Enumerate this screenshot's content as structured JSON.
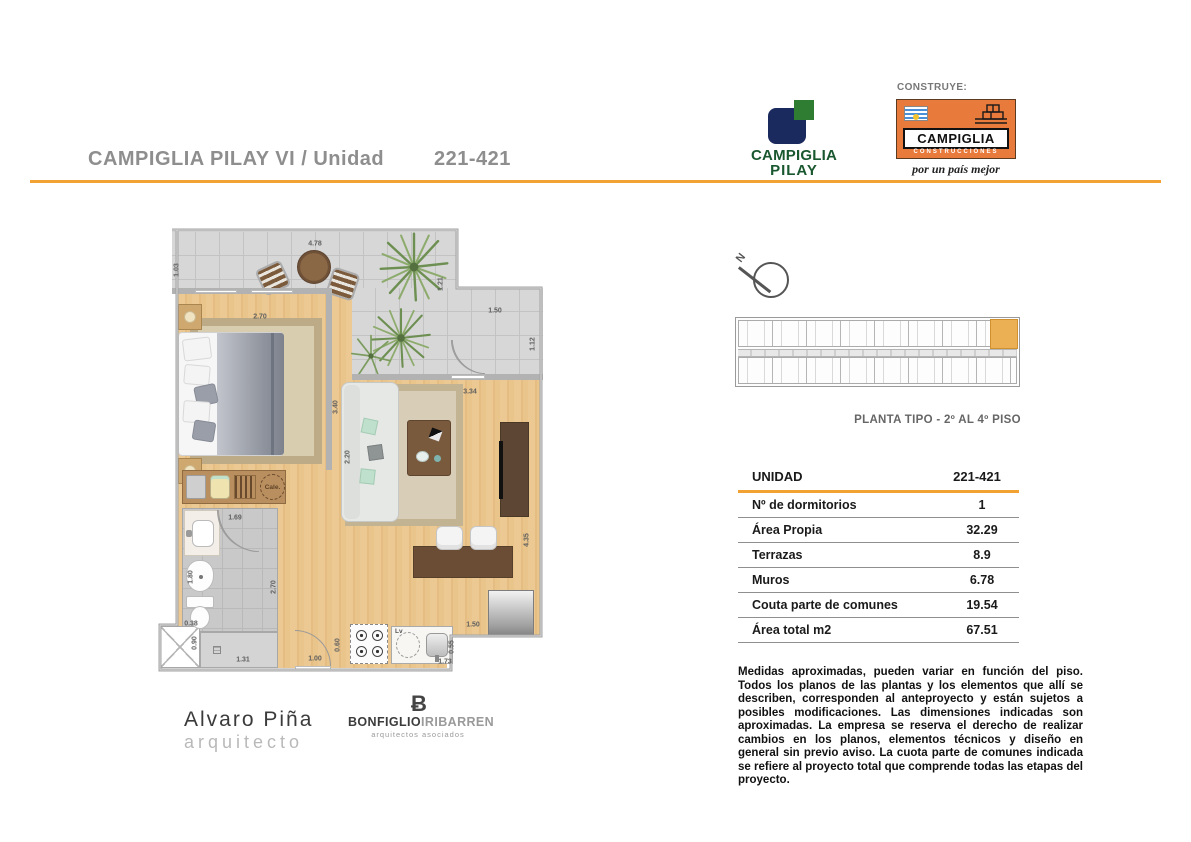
{
  "page": {
    "title_prefix": "CAMPIGLIA PILAY VI  /  Unidad",
    "unit_number": "221-421"
  },
  "logos": {
    "pilay": {
      "line1": "CAMPIGLIA",
      "line2": "PILAY"
    },
    "construye_label": "CONSTRUYE:",
    "constructor": {
      "name": "CAMPIGLIA",
      "sub": "CONSTRUCCIONES",
      "tagline": "por un país mejor"
    }
  },
  "keyplan": {
    "north_label": "N",
    "caption": "PLANTA TIPO - 2º AL 4º PISO"
  },
  "spec_table": {
    "header_label": "UNIDAD",
    "header_value": "221-421",
    "rows": [
      {
        "label": "Nº de dormitorios",
        "value": "1"
      },
      {
        "label": "Área Propia",
        "value": "32.29"
      },
      {
        "label": "Terrazas",
        "value": "8.9"
      },
      {
        "label": "Muros",
        "value": "6.78"
      },
      {
        "label": "Couta parte de comunes",
        "value": "19.54"
      },
      {
        "label": "Área total m2",
        "value": "67.51"
      }
    ]
  },
  "disclaimer": "Medidas aproximadas, pueden variar en función del piso. Todos los planos de las plantas y los elementos que allí se describen, corresponden al anteproyecto y están sujetos a posibles modificaciones. Las dimensiones indicadas son aproximadas. La empresa se reserva el derecho de realizar cambios en los planos, elementos técnicos y diseño en general sin previo aviso. La cuota parte de comunes indicada se refiere al proyecto total que comprende todas las etapas del proyecto.",
  "signatures": {
    "architect": {
      "name": "Alvaro Piña",
      "title": "arquitecto"
    },
    "studio": {
      "mark": "Ƀ",
      "name1": "BONFIGLIO",
      "name2": "IRIBARREN",
      "sub": "arquitectos asociados"
    }
  },
  "floorplan": {
    "annotations": {
      "heater": "Cale.",
      "dishwasher": "Lv"
    },
    "dim_labels": [
      {
        "t": "4.78",
        "x": 160,
        "y": 20,
        "v": 0
      },
      {
        "t": "1.03",
        "x": 22,
        "y": 46,
        "v": 1
      },
      {
        "t": "2.70",
        "x": 105,
        "y": 93,
        "v": 0
      },
      {
        "t": "1.21",
        "x": 286,
        "y": 60,
        "v": 1
      },
      {
        "t": "1.50",
        "x": 340,
        "y": 87,
        "v": 0
      },
      {
        "t": "1.12",
        "x": 378,
        "y": 120,
        "v": 1
      },
      {
        "t": "3.40",
        "x": 181,
        "y": 183,
        "v": 1
      },
      {
        "t": "3.34",
        "x": 315,
        "y": 168,
        "v": 0
      },
      {
        "t": "2.20",
        "x": 193,
        "y": 233,
        "v": 1
      },
      {
        "t": "1.69",
        "x": 80,
        "y": 294,
        "v": 0
      },
      {
        "t": "1.80",
        "x": 36,
        "y": 353,
        "v": 1
      },
      {
        "t": "2.70",
        "x": 119,
        "y": 363,
        "v": 1
      },
      {
        "t": "0.38",
        "x": 36,
        "y": 400,
        "v": 0
      },
      {
        "t": "0.90",
        "x": 40,
        "y": 419,
        "v": 1
      },
      {
        "t": "1.31",
        "x": 88,
        "y": 436,
        "v": 0
      },
      {
        "t": "1.00",
        "x": 160,
        "y": 435,
        "v": 0
      },
      {
        "t": "0.60",
        "x": 183,
        "y": 421,
        "v": 1
      },
      {
        "t": "1.73",
        "x": 290,
        "y": 438,
        "v": 0
      },
      {
        "t": "0.55",
        "x": 297,
        "y": 423,
        "v": 1
      },
      {
        "t": "1.50",
        "x": 318,
        "y": 401,
        "v": 0
      },
      {
        "t": "4.35",
        "x": 372,
        "y": 316,
        "v": 1
      }
    ]
  },
  "colors": {
    "accent_orange": "#F2A233",
    "constructor_orange": "#E87A3C",
    "logo_navy": "#1B2A5E",
    "logo_green": "#2E7D32",
    "brand_green_text": "#19572F",
    "highlight_unit": "#ECB054"
  }
}
